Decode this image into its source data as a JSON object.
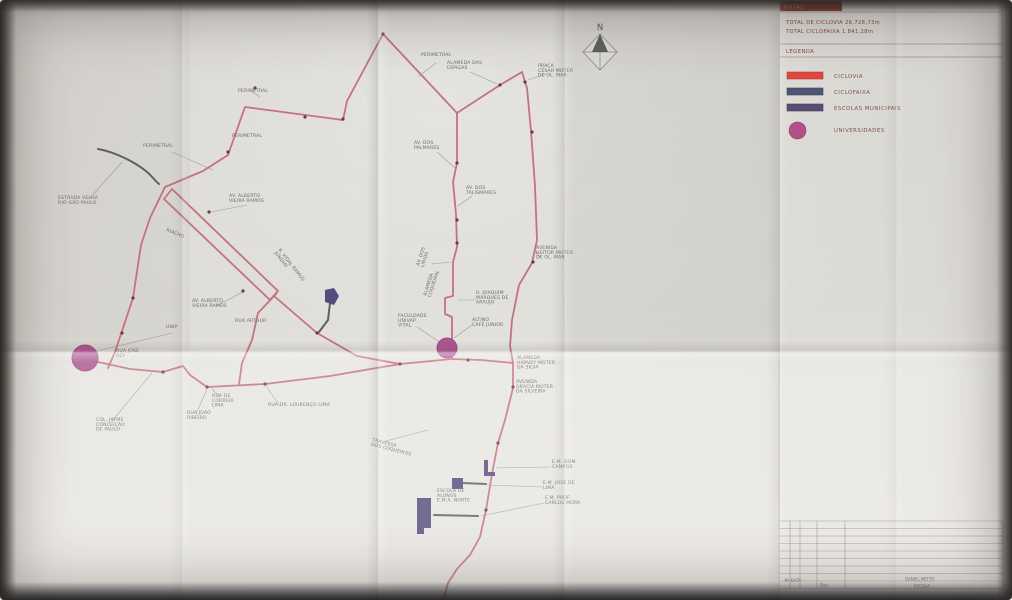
{
  "panel": {
    "tab_label": "NOTAS",
    "totals": [
      "TOTAL DE CICLOVIA  26.728,73m",
      "TOTAL CICLOFAIXA  1.841,28m"
    ],
    "legend_title": "LEGENDA",
    "legend": [
      {
        "swatch": "bar",
        "color": "#e0483e",
        "edge": "#b23a32",
        "label": "CICLOVIA"
      },
      {
        "swatch": "bar",
        "color": "#4c5574",
        "edge": "#3c4460",
        "label": "CICLOFAIXA"
      },
      {
        "swatch": "bar",
        "color": "#584d72",
        "edge": "#463c5e",
        "label": "ESCOLAS MUNICIPAIS"
      },
      {
        "swatch": "circle",
        "color": "#b25187",
        "edge": "#8e3f6e",
        "label": "UNIVERSIDADES"
      }
    ],
    "titleblock": {
      "rev_cells": "Nº  DATA",
      "drawn_label": "Des.",
      "author": "DANIEL NETTO",
      "scale_label": "ESCALA"
    }
  },
  "map": {
    "north_label": "N",
    "colors": {
      "ciclovia": "#c4727e",
      "ciclofaixa": "#5c6166",
      "school": "#564c7c",
      "university": "#ad5590",
      "university_edge": "#9c4a80",
      "dot": "#6d3a44",
      "leader": "#9a9b98",
      "label": "#6b6c70"
    },
    "routes": {
      "ciclovia": [
        "M228,155 L245,107 L343,120 L347,101 L383,34 L457,113",
        "M457,113 L457,163 L453,182 L456,214 L457,247 L453,262 L453,296 L445,298 L445,314 L452,317 L452,359",
        "M457,113 L500,85 L522,72 L527,88 L531,131 L535,186 L537,240 L532,263 L519,285 L512,320 L510,346 L513,363 L513,388 L505,420 L498,443 L492,474 L486,510 L480,537 L470,555 L457,569 L448,583 L444,598",
        "M98,362 L130,369 L163,372 L183,366 L190,375 L207,387 L265,384 L330,376 L400,364 L452,359 L481,360 L513,363",
        "M228,155 L203,171 L165,187 L150,218 L141,245 L133,298 L115,352 L108,368",
        "M172,189 L278,291",
        "M164,199 L270,300",
        "M172,189 L164,199 M278,291 L270,300",
        "M274,296 L317,333 L357,356 L400,364",
        "M276,294 L258,313 L252,340 L242,363 L239,384"
      ],
      "ciclofaixa": [
        "M98,149 C115,152 135,162 147,172 C153,177 155,181 159,184",
        "M330,303 L328,320 L319,332",
        "M434,515 L478,516",
        "M463,483 L486,484"
      ]
    },
    "school_shapes": [
      "M325,290 L334,288 L339,296 L334,305 L325,302 Z",
      "M484,460 L488,460 L488,472 L495,472 L495,476 L484,476 Z",
      "M452,478 L463,478 L463,489 L452,489 Z",
      "M417,498 L431,498 L431,528 L424,528 L424,534 L417,534 Z"
    ],
    "universities": [
      {
        "cx": 85,
        "cy": 358,
        "r": 13
      },
      {
        "cx": 447,
        "cy": 348,
        "r": 10
      }
    ],
    "junction_dots": [
      [
        255,
        88
      ],
      [
        228,
        152
      ],
      [
        343,
        119
      ],
      [
        383,
        34
      ],
      [
        457,
        163
      ],
      [
        457,
        220
      ],
      [
        457,
        243
      ],
      [
        500,
        85
      ],
      [
        525,
        82
      ],
      [
        532,
        132
      ],
      [
        533,
        262
      ],
      [
        513,
        387
      ],
      [
        122,
        333
      ],
      [
        163,
        372
      ],
      [
        207,
        387
      ],
      [
        265,
        384
      ],
      [
        400,
        364
      ],
      [
        468,
        360
      ],
      [
        209,
        212
      ],
      [
        243,
        291
      ],
      [
        317,
        333
      ],
      [
        498,
        443
      ],
      [
        486,
        510
      ],
      [
        133,
        298
      ],
      [
        305,
        117
      ]
    ],
    "leaders": [
      "M90,198 L122,162",
      "M172,152 L213,170",
      "M436,63 L419,76",
      "M470,72 L497,84",
      "M546,74 L528,80",
      "M437,152 L455,168",
      "M472,196 L458,206",
      "M432,264 L451,262",
      "M247,205 L211,212",
      "M216,306 L243,292",
      "M172,333 L97,351",
      "M417,327 L441,343",
      "M476,300 L458,300",
      "M472,325 L454,338",
      "M540,257 L535,251",
      "M220,397 L212,389",
      "M196,414 L207,389",
      "M112,421 L152,373",
      "M280,406 L266,386",
      "M386,441 L428,430",
      "M551,467 L496,468",
      "M542,487 L487,485",
      "M544,503 L481,516",
      "M260,97 L251,91"
    ],
    "labels": [
      {
        "text": "ESTRADA VELHA\nRIO–SÃO PAULO",
        "x": 58,
        "y": 199,
        "rot": 0
      },
      {
        "text": "PERIMETRAL",
        "x": 143,
        "y": 147,
        "rot": 0
      },
      {
        "text": "PERIMETRAL",
        "x": 232,
        "y": 137,
        "rot": 0
      },
      {
        "text": "PERIMETRAL",
        "x": 238,
        "y": 92,
        "rot": 0
      },
      {
        "text": "PERIMETRAL",
        "x": 421,
        "y": 56,
        "rot": 0
      },
      {
        "text": "ALAMEDA DAS\nESPIGAS",
        "x": 447,
        "y": 64,
        "rot": 0
      },
      {
        "text": "PRAÇA\nCÉSAR MOTER\nDE OL. MAR",
        "x": 538,
        "y": 67,
        "rot": 0
      },
      {
        "text": "AV. DOS\nPALMARES",
        "x": 414,
        "y": 144,
        "rot": 0
      },
      {
        "text": "AV. DOS\nTALISMARES",
        "x": 466,
        "y": 189,
        "rot": 0
      },
      {
        "text": "AV. DOS\nLÍRIOS",
        "x": 419,
        "y": 266,
        "rot": -72
      },
      {
        "text": "AV. ALBERTO\nVIEIRA RAMOS",
        "x": 229,
        "y": 197,
        "rot": 0
      },
      {
        "text": "AV. ALBERTO\nVIEIRA RAMOS",
        "x": 192,
        "y": 302,
        "rot": 0
      },
      {
        "text": "RUA ARTHUR",
        "x": 235,
        "y": 322,
        "rot": 0
      },
      {
        "text": "R. VIDAL RAMOS\nJUNDIAÍ",
        "x": 278,
        "y": 250,
        "rot": 52
      },
      {
        "text": "RIACHO",
        "x": 166,
        "y": 231,
        "rot": 22
      },
      {
        "text": "UNIP",
        "x": 166,
        "y": 328,
        "rot": 0
      },
      {
        "text": "RUA JOSÉ\nREY",
        "x": 116,
        "y": 352,
        "rot": 0
      },
      {
        "text": "FACULDADE\nUNIVAP\nVITAL",
        "x": 398,
        "y": 317,
        "rot": 0
      },
      {
        "text": "ALAMEDA\nCOQUEIRAL",
        "x": 426,
        "y": 296,
        "rot": -72
      },
      {
        "text": "R. JOAQUIM\nMARQUES DE\nARAUJO",
        "x": 476,
        "y": 294,
        "rot": 0
      },
      {
        "text": "ALTINO\nCAFÉ JUNIOR",
        "x": 472,
        "y": 321,
        "rot": 0
      },
      {
        "text": "AVENIDA\nHEITOR MOTER\nDE OL. MAR",
        "x": 536,
        "y": 249,
        "rot": 0
      },
      {
        "text": "ALAMEDA\nHARVEY MOTER\nDA SILVA",
        "x": 517,
        "y": 359,
        "rot": 0
      },
      {
        "text": "AVENIDA\nGRACIA MOTER\nDA SILVEIRA",
        "x": 516,
        "y": 383,
        "rot": 0
      },
      {
        "text": "RUA DE\nCORREIA\nLIMA",
        "x": 212,
        "y": 397,
        "rot": 0
      },
      {
        "text": "RUA JOÃO\nRIBEIRO",
        "x": 187,
        "y": 414,
        "rot": 0
      },
      {
        "text": "COL. JAYME\nCONCEIÇÃO\nDE PAULO",
        "x": 96,
        "y": 421,
        "rot": 0
      },
      {
        "text": "RUA DR. LOURENÇO LIMA",
        "x": 268,
        "y": 406,
        "rot": 0
      },
      {
        "text": "TRAVESSA\nDOS COQUEIROS",
        "x": 372,
        "y": 441,
        "rot": 14
      },
      {
        "text": "E.M. DOM\nCAMPOS",
        "x": 552,
        "y": 463,
        "rot": 0
      },
      {
        "text": "E.M. JOSÉ DE\nLIMA",
        "x": 543,
        "y": 484,
        "rot": 0
      },
      {
        "text": "E.M. PROF.\nCARLOS MORA",
        "x": 545,
        "y": 499,
        "rot": 0
      },
      {
        "text": "ESCOLA DE\nALUNOS\nE.M.A. NORTE",
        "x": 437,
        "y": 492,
        "rot": 0
      }
    ]
  }
}
